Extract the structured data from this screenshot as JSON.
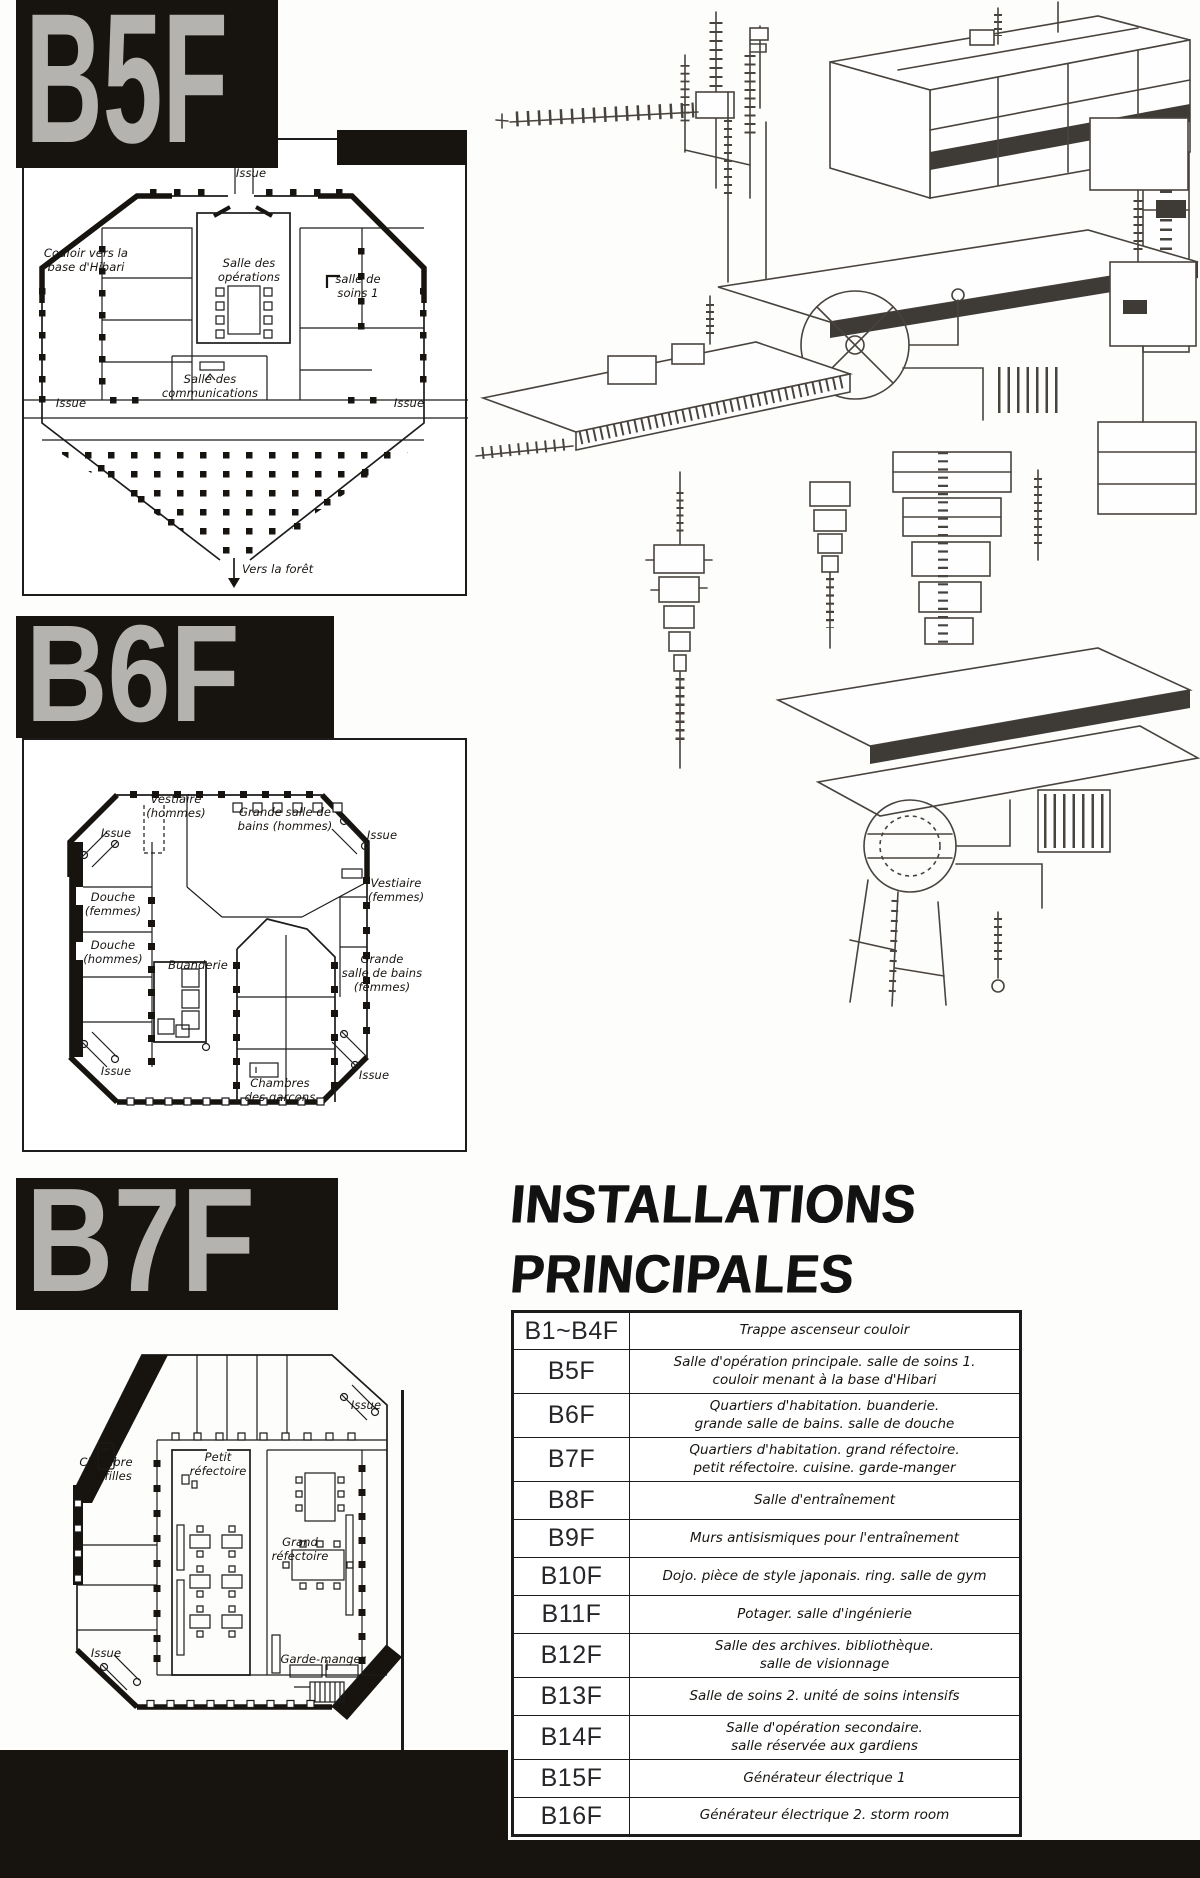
{
  "colors": {
    "paper": "#fdfdfc",
    "ink": "#1c1c1c",
    "banner_bg": "#17130f",
    "banner_text": "#b5b3b0"
  },
  "floors": {
    "b5f": {
      "title": "B5F",
      "labels": {
        "issue_top": "Issue",
        "corridor_hibari": "Couloir vers la\nbase d'Hibari",
        "operations": "Salle des\nopérations",
        "care_room": "salle de\nsoins 1",
        "communications": "Salle des\ncommunications",
        "issue_left": "Issue",
        "issue_right": "Issue",
        "to_forest": "Vers la forêt"
      }
    },
    "b6f": {
      "title": "B6F",
      "labels": {
        "vestiaire_h": "Vestiaire\n(hommes)",
        "bains_h": "Grande salle de\nbains (hommes)",
        "issue_tl": "Issue",
        "issue_tr": "Issue",
        "douche_f": "Douche\n(femmes)",
        "douche_h": "Douche\n(hommes)",
        "buanderie": "Buanderie",
        "vestiaire_f": "Vestiaire\n(femmes)",
        "bains_f": "Grande\nsalle de bains\n(femmes)",
        "chambres_garcons": "Chambres\ndes garçons",
        "issue_bl": "Issue",
        "issue_br": "Issue"
      }
    },
    "b7f": {
      "title": "B7F",
      "labels": {
        "issue_tr": "Issue",
        "chambre_filles": "Chambre\ndes filles",
        "petit_refectoire": "Petit\nréfectoire",
        "grand_refectoire": "Grand\nréfectoire",
        "issue_bl": "Issue",
        "garde_manger": "Garde-manger"
      }
    }
  },
  "installations": {
    "title_line1": "INSTALLATIONS",
    "title_line2": "PRINCIPALES",
    "rows": [
      {
        "floor": "B1~B4F",
        "desc": "Trappe ascenseur couloir"
      },
      {
        "floor": "B5F",
        "desc": "Salle d'opération principale. salle de soins 1.\ncouloir menant à la base d'Hibari"
      },
      {
        "floor": "B6F",
        "desc": "Quartiers d'habitation. buanderie.\ngrande salle de bains. salle de douche"
      },
      {
        "floor": "B7F",
        "desc": "Quartiers d'habitation. grand réfectoire.\npetit réfectoire. cuisine. garde-manger"
      },
      {
        "floor": "B8F",
        "desc": "Salle d'entraînement"
      },
      {
        "floor": "B9F",
        "desc": "Murs antisismiques pour l'entraînement"
      },
      {
        "floor": "B10F",
        "desc": "Dojo. pièce de style japonais. ring. salle de gym"
      },
      {
        "floor": "B11F",
        "desc": "Potager. salle d'ingénierie"
      },
      {
        "floor": "B12F",
        "desc": "Salle des archives. bibliothèque.\nsalle de visionnage"
      },
      {
        "floor": "B13F",
        "desc": "Salle de soins 2. unité de soins intensifs"
      },
      {
        "floor": "B14F",
        "desc": "Salle d'opération secondaire.\nsalle réservée aux gardiens"
      },
      {
        "floor": "B15F",
        "desc": "Générateur électrique 1"
      },
      {
        "floor": "B16F",
        "desc": "Générateur électrique 2. storm room"
      }
    ]
  }
}
